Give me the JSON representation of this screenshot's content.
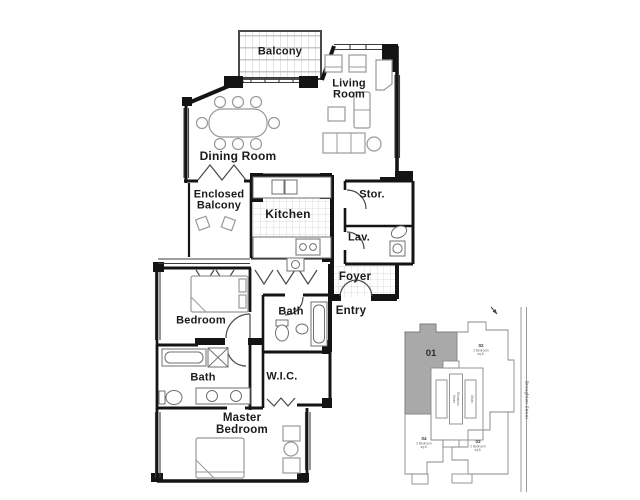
{
  "colors": {
    "wall": "#141414",
    "furniture_line": "#999999",
    "tile_line": "#cfcfcf",
    "keyplan_line": "#8a8a8a",
    "unit_highlight_fill": "#a9a9a9"
  },
  "floor_plan": {
    "rooms": {
      "balcony": "Balcony",
      "living_room": "Living Room",
      "dining_room": "Dining Room",
      "enclosed_balcony": "Enclosed Balcony",
      "kitchen": "Kitchen",
      "storage": "Stor.",
      "lavatory": "Lav.",
      "foyer": "Foyer",
      "entry": "Entry",
      "bedroom": "Bedroom",
      "bath_ensuite": "Bath",
      "bath_main": "Bath",
      "wic": "W.I.C.",
      "master_bedroom": "Master Bedroom"
    }
  },
  "key_plan": {
    "highlighted_unit": "01",
    "units": [
      {
        "id": "01",
        "highlighted": true
      },
      {
        "id": "02",
        "highlighted": false,
        "lines": [
          "2 Bedroom",
          "sq.ft."
        ]
      },
      {
        "id": "03",
        "highlighted": false,
        "lines": [
          "2 Bedroom",
          "sq.ft."
        ]
      },
      {
        "id": "04",
        "highlighted": false,
        "lines": [
          "2 Bedroom",
          "sq.ft."
        ]
      }
    ],
    "core_labels": [
      "Stairs",
      "Elevators",
      "Stairs"
    ],
    "street_label": "Broughton Street"
  }
}
